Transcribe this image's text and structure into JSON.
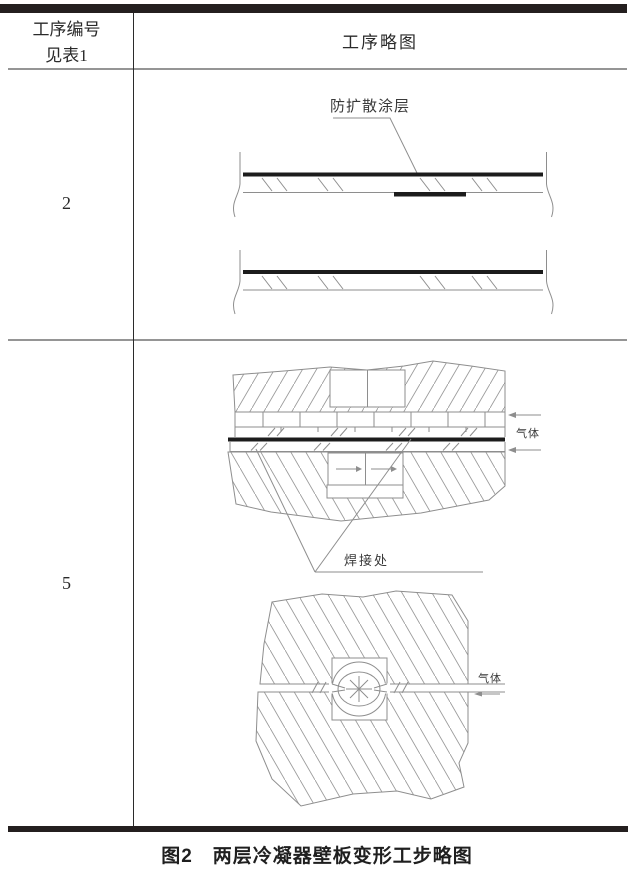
{
  "table": {
    "header": {
      "process_no_line1": "工序编号",
      "process_no_line2": "见表1",
      "sketch_col": "工序略图"
    },
    "rows": [
      {
        "step_no": "2"
      },
      {
        "step_no": "5"
      }
    ]
  },
  "step2_diagram": {
    "coating_label": "防扩散涂层"
  },
  "step5_weld_diagram": {
    "gas_label": "气体",
    "weld_label": "焊接处"
  },
  "step5_bulge_diagram": {
    "gas_label": "气体"
  },
  "caption": "图2　两层冷凝器壁板变形工步略图",
  "colors": {
    "sketch_line": "#8e8e8e",
    "hatch_line": "#9b9b9b",
    "table_line": "#2b2b2b",
    "heavy_bar": "#241f1f",
    "plate_black": "#1c1c1c"
  }
}
